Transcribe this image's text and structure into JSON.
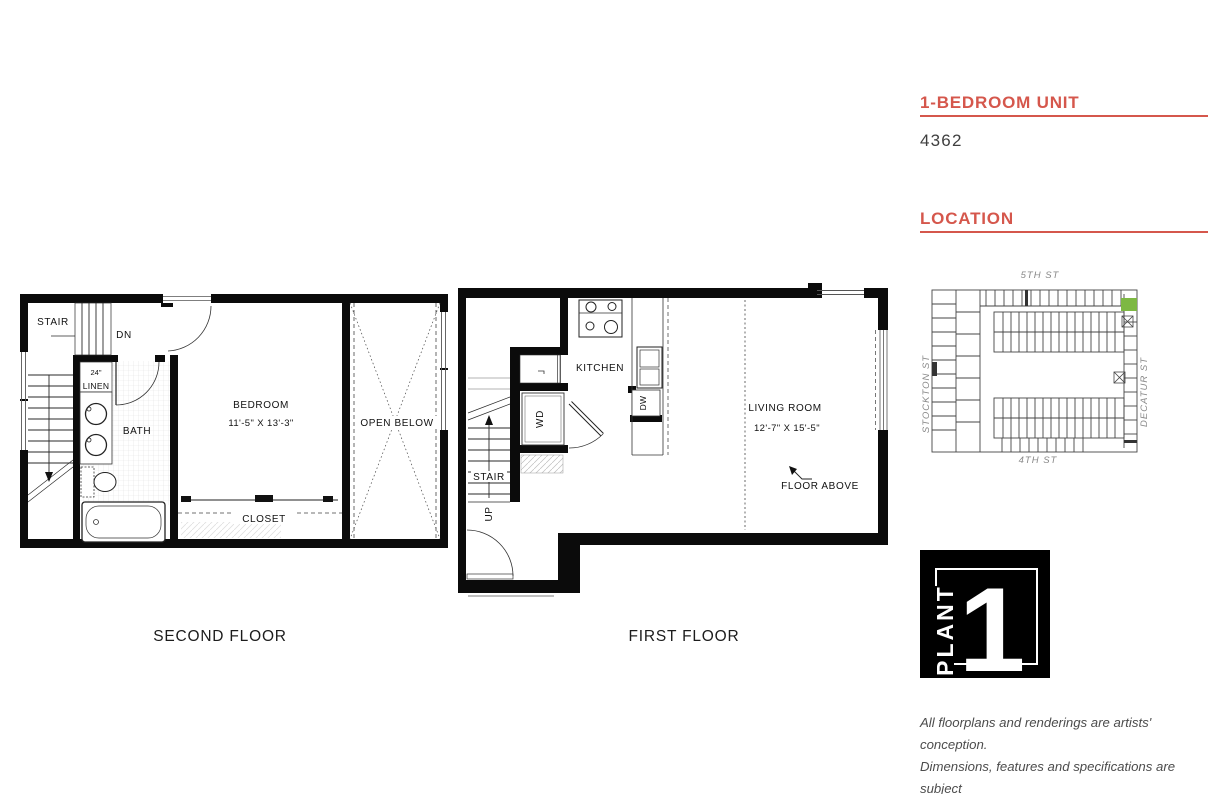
{
  "colors": {
    "accent": "#d5574c",
    "highlight_green": "#7db843"
  },
  "unit": {
    "type_heading": "1-BEDROOM UNIT",
    "number": "4362"
  },
  "location": {
    "heading": "LOCATION",
    "street_top": "5TH ST",
    "street_bottom": "4TH ST",
    "street_left": "STOCKTON ST",
    "street_right": "DECATUR ST"
  },
  "second_floor": {
    "caption": "SECOND FLOOR",
    "stair": "STAIR",
    "dn": "DN",
    "shelf_width": "24\"",
    "linen": "LINEN",
    "bath": "BATH",
    "bedroom": "BEDROOM",
    "bedroom_dims": "11'-5\" X 13'-3\"",
    "open_below": "OPEN BELOW",
    "closet": "CLOSET"
  },
  "first_floor": {
    "caption": "FIRST FLOOR",
    "kitchen": "KITCHEN",
    "dw": "DW",
    "wd": "WD",
    "stair": "STAIR",
    "up": "UP",
    "living_room": "LIVING ROOM",
    "living_dims": "12'-7\" X 15'-5\"",
    "floor_above": "FLOOR ABOVE"
  },
  "logo": {
    "brand": "PLANT",
    "number": "1"
  },
  "disclaimer": {
    "line1": "All floorplans and renderings are artists' conception.",
    "line2": "Dimensions, features and specifications are subject",
    "line3": "to change at the discretion of the builder."
  }
}
